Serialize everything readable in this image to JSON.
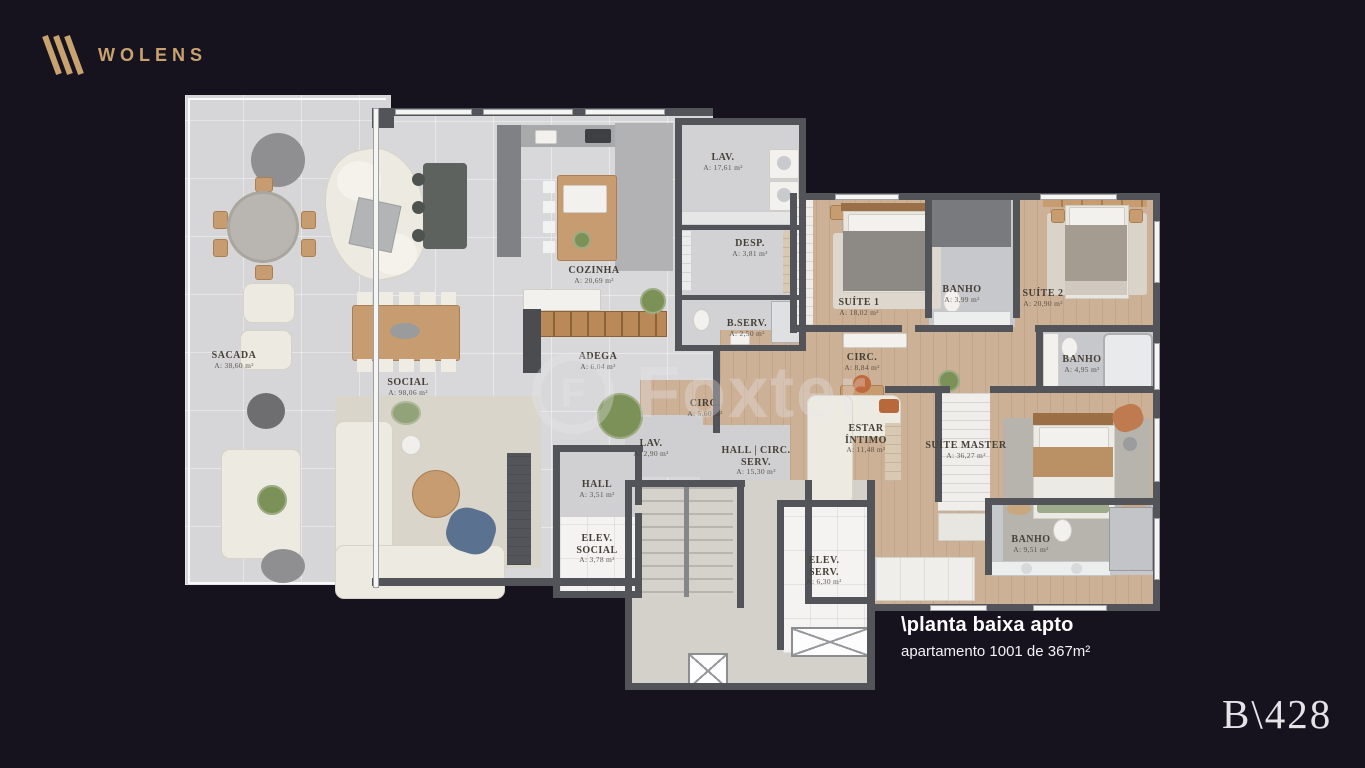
{
  "brand": {
    "name": "WOLENS"
  },
  "caption": {
    "title": "\\planta baixa apto",
    "subtitle": "apartamento 1001 de 367m²"
  },
  "page_code": "B\\428",
  "watermark": {
    "text": "Foxter",
    "initial": "F"
  },
  "colors": {
    "background": "#16131f",
    "accent_gold": "#c9a36f",
    "wall": "#53545a",
    "floor_gray": "#d6d6d8",
    "floor_wood": "#ccb197",
    "floor_bath": "#c7c8cc",
    "floor_common": "#d3d1c9",
    "label_text": "#453f37"
  },
  "rooms": [
    {
      "name": "SACADA",
      "area": "A: 38,60 m²"
    },
    {
      "name": "SOCIAL",
      "area": "A: 98,06 m²"
    },
    {
      "name": "COZINHA",
      "area": "A: 20,69 m²"
    },
    {
      "name": "ADEGA",
      "area": "A: 6,04 m²"
    },
    {
      "name": "LAV.",
      "area": "A: 17,61 m²"
    },
    {
      "name": "DESP.",
      "area": "A: 3,81 m²"
    },
    {
      "name": "B.SERV.",
      "area": "A: 2,50 m²"
    },
    {
      "name": "SUÍTE 1",
      "area": "A: 18,02 m²"
    },
    {
      "name": "BANHO",
      "area": "A: 3,99 m²"
    },
    {
      "name": "SUÍTE 2",
      "area": "A: 20,90 m²"
    },
    {
      "name": "BANHO",
      "area": "A: 4,95 m²"
    },
    {
      "name": "CIRC.",
      "area": "A: 8,84 m²"
    },
    {
      "name": "CIRC.",
      "area": "A: 5,60 m²"
    },
    {
      "name": "LAV.",
      "area": "A: 2,90 m²"
    },
    {
      "name": "HALL | CIRC. SERV.",
      "area": "A: 15,30 m²"
    },
    {
      "name": "ESTAR ÍNTIMO",
      "area": "A: 11,48 m²"
    },
    {
      "name": "SUÍTE MASTER",
      "area": "A: 36,27 m²"
    },
    {
      "name": "HALL",
      "area": "A: 3,51 m²"
    },
    {
      "name": "ELEV. SOCIAL",
      "area": "A: 3,78 m²"
    },
    {
      "name": "ELEV. SERV.",
      "area": "A: 6,30 m²"
    },
    {
      "name": "BANHO",
      "area": "A: 9,51 m²"
    }
  ]
}
